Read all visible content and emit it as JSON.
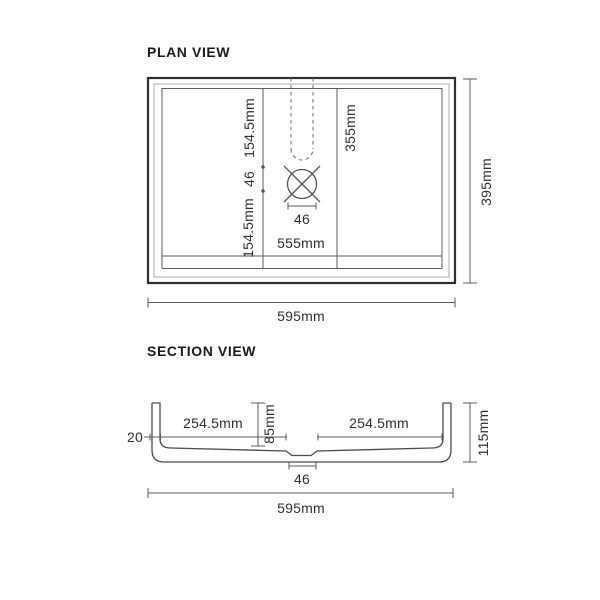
{
  "plan_view": {
    "title": "PLAN VIEW",
    "dims": {
      "top_offset": "154.5mm",
      "drain_gap_vertical": "46",
      "bottom_offset": "154.5mm",
      "bowl_depth": "355mm",
      "drain_width": "46",
      "bowl_width": "555mm",
      "overall_width": "595mm",
      "overall_depth": "395mm"
    }
  },
  "section_view": {
    "title": "SECTION VIEW",
    "dims": {
      "rim_thickness": "20",
      "left_bottom_run": "254.5mm",
      "inner_depth": "85mm",
      "right_bottom_run": "254.5mm",
      "overall_height": "115mm",
      "drain_recess_width": "46",
      "overall_width": "595mm"
    }
  },
  "colors": {
    "line_dark": "#2e2e2e",
    "line_mid": "#5a5a5a",
    "line_light": "#9a9a9a",
    "text": "#303030",
    "background": "#ffffff"
  }
}
